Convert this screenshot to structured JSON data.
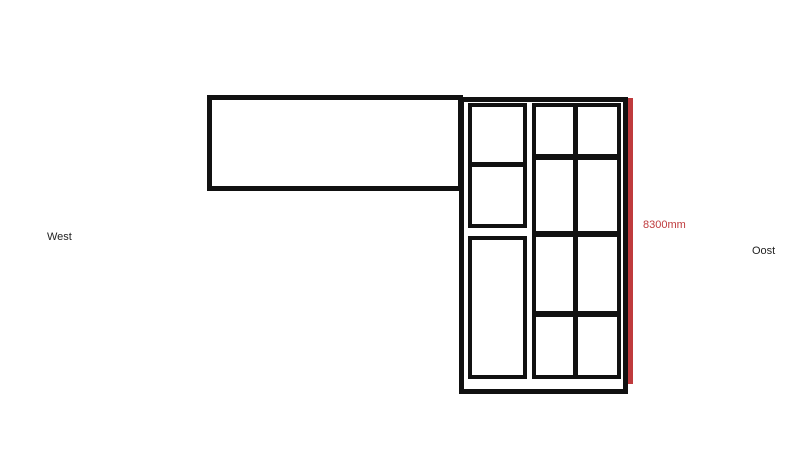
{
  "diagram": {
    "labels": {
      "west": "West",
      "oost": "Oost",
      "dimension": "8300mm"
    },
    "colors": {
      "background": "#ffffff",
      "line": "#111111",
      "accent": "#bf3b3d"
    }
  }
}
